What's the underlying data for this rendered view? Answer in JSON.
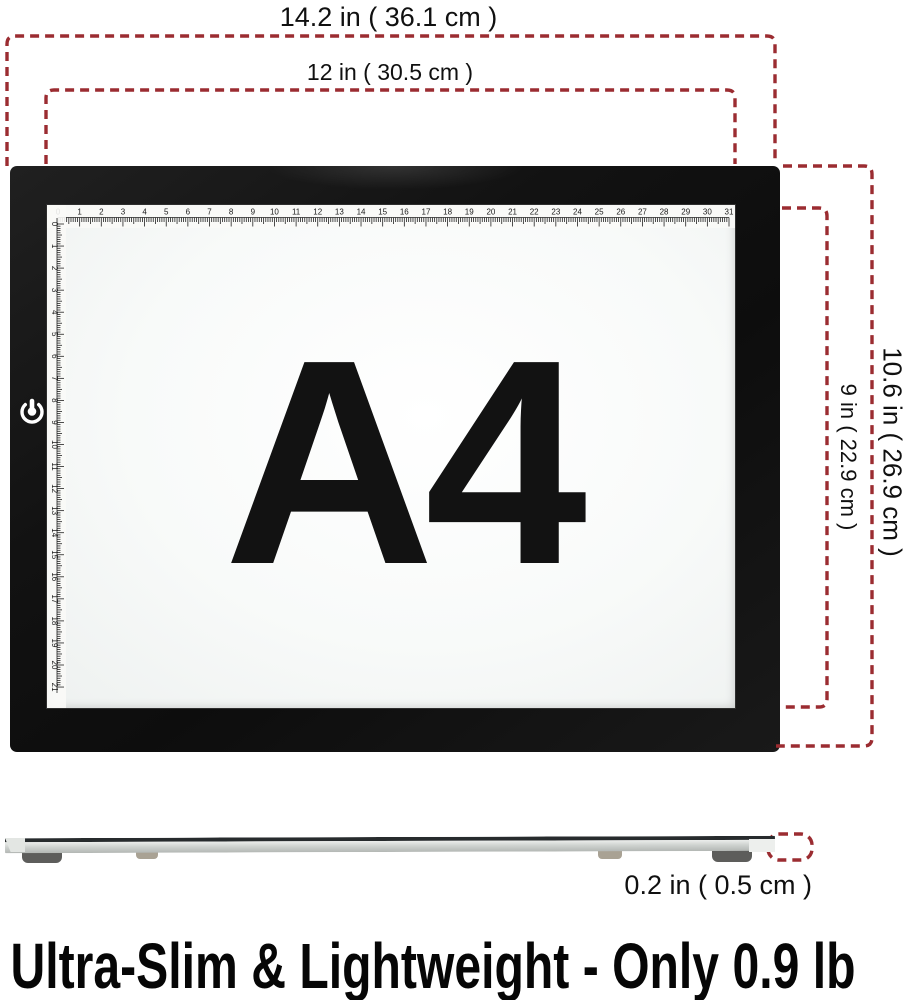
{
  "colors": {
    "dimension_line": "#9b2c31",
    "pad_frame": "#161616",
    "ink": "#141414"
  },
  "dims": {
    "outer_width": "14.2 in ( 36.1 cm )",
    "inner_width": "12 in ( 30.5 cm )",
    "outer_height": "10.6 in ( 26.9 cm )",
    "inner_height": "9 in ( 22.9 cm )",
    "thickness": "0.2 in ( 0.5 cm )"
  },
  "pad": {
    "size_label": "A4",
    "ruler_top_numbers": [
      0,
      1,
      2,
      3,
      4,
      5,
      6,
      7,
      8,
      9,
      10,
      11,
      12,
      13,
      14,
      15,
      16,
      17,
      18,
      19,
      20,
      21,
      22,
      23,
      24,
      25,
      26,
      27,
      28,
      29,
      30,
      31
    ],
    "ruler_left_numbers": [
      0,
      1,
      2,
      3,
      4,
      5,
      6,
      7,
      8,
      9,
      10,
      11,
      12,
      13,
      14,
      15,
      16,
      17,
      18,
      19,
      20,
      21
    ],
    "ruler_unit": "cm"
  },
  "headline": "Ultra-Slim & Lightweight - Only 0.9 lb"
}
